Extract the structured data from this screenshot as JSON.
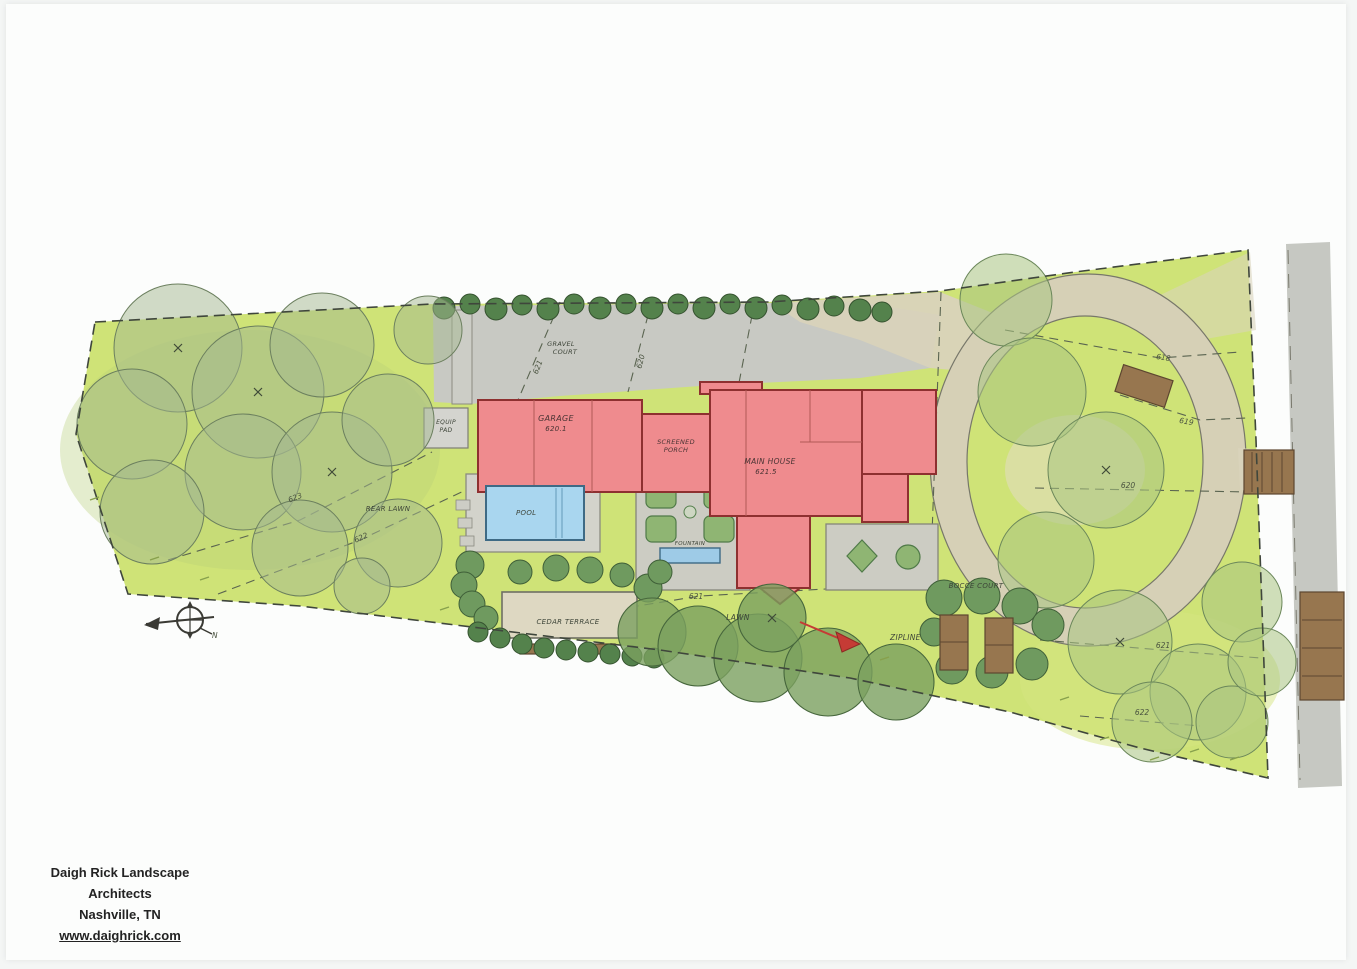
{
  "document_type": "landscape architecture site plan (scanned hand-rendered drawing)",
  "footer": {
    "firm": "Daigh Rick Landscape Architects",
    "location": "Nashville, TN",
    "website": "www.daighrick.com"
  },
  "plan": {
    "labels": {
      "gravel_court_line1": "GRAVEL",
      "gravel_court_line2": "COURT",
      "equip_pad_line1": "EQUIP",
      "equip_pad_line2": "PAD",
      "garage": "GARAGE",
      "garage_elevation": "620.1",
      "screened_porch_line1": "SCREENED",
      "screened_porch_line2": "PORCH",
      "main_house": "MAIN HOUSE",
      "main_house_elevation": "621.5",
      "pool": "POOL",
      "fountain": "FOUNTAIN",
      "rear_lawn": "REAR LAWN",
      "cedar_terrace": "CEDAR TERRACE",
      "lawn": "LAWN",
      "zipline": "ZIPLINE",
      "bocce_court": "BOCCE COURT",
      "north": "N"
    },
    "contour_elevations": {
      "c618": "618",
      "c619": "619",
      "c620": "620",
      "c621": "621",
      "c622": "622",
      "c623": "623"
    },
    "colors": {
      "lawn_green": "#cfe377",
      "house_pink": "#ef8b8e",
      "pool_blue": "#a9d6ef",
      "drive_gray": "#c8c9c3",
      "gravel_tan": "#d9d3bb",
      "tree_green": "#9ab585",
      "hedge_green": "#54824c",
      "wood_brown": "#97764f"
    }
  }
}
